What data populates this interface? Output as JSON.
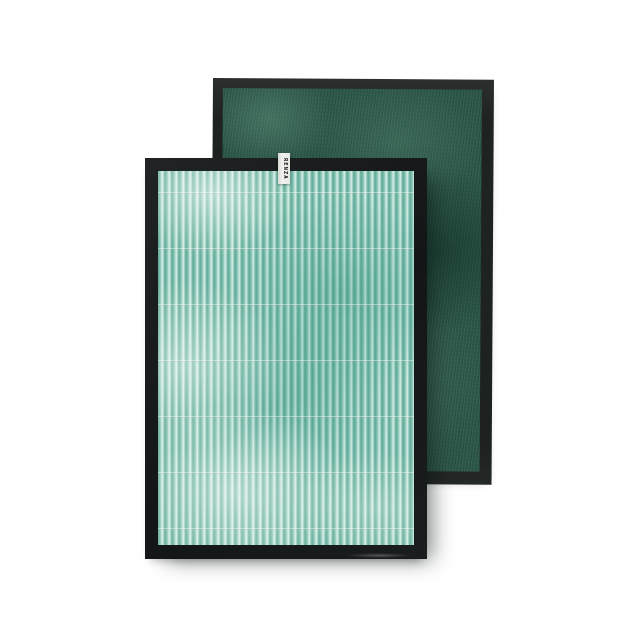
{
  "scene": {
    "description": "Product photo of two air purifier replacement filter panels on a white background",
    "background_color": "#ffffff"
  },
  "filters": {
    "back": {
      "kind": "carbon-deodorizing-filter-panel",
      "frame_color": "#212524",
      "media_color": "#2c5748"
    },
    "front": {
      "kind": "pleated-filter-panel",
      "frame_color": "#17191b",
      "media_color": "#85c4b3",
      "pleat_highlight_color": "#dcf1ea",
      "glue_line_count": 7,
      "tag": {
        "label": "RENZA",
        "background_color": "#ecede9",
        "text_color": "#161616"
      }
    }
  }
}
